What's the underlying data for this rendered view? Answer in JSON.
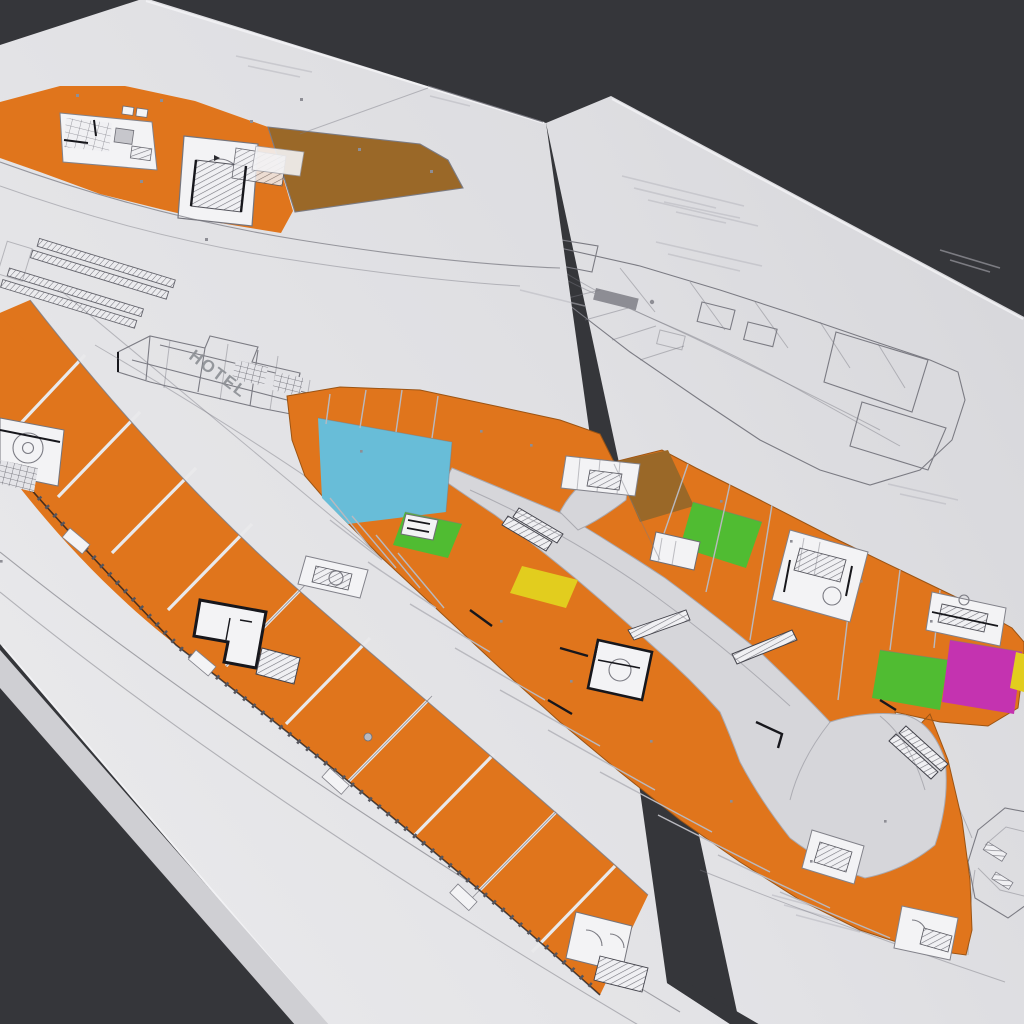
{
  "viewport": {
    "description_note": "",
    "background_color": "#35363a"
  },
  "labels": {
    "hotel": "HOTEL"
  },
  "colors": {
    "background": "#35363a",
    "sheet_light": "#e6e6e8",
    "sheet_dark": "#dbdbdf",
    "under_sheet": "#cfcfd3",
    "retail_orange": "#e0751c",
    "anchor_cyan": "#68bdd8",
    "zone_green": "#50bc32",
    "zone_yellow": "#e2cd1e",
    "zone_magenta": "#c433b0",
    "zone_brown": "#9a6828",
    "concourse": "#d6d6da",
    "line_gray": "#7b7b83",
    "wall_dark": "#17171c",
    "detail_light": "#f3f3f5"
  }
}
